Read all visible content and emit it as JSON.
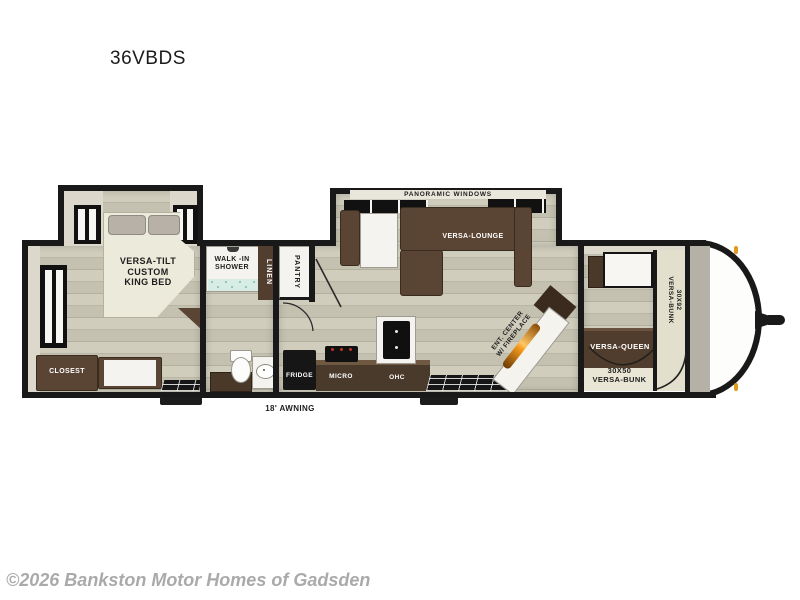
{
  "page": {
    "model": "36VBDS",
    "copyright": "©2026 Bankston Motor Homes of Gadsden"
  },
  "floorplan": {
    "awning_label": "18' AWNING",
    "rear_bedroom": {
      "bed_label": "VERSA-TILT\nCUSTOM\nKING BED",
      "closet_label": "CLOSEST"
    },
    "bathroom": {
      "shower_label": "WALK -IN\nSHOWER",
      "linen_label": "LINEN"
    },
    "kitchen": {
      "pantry_label": "PANTRY",
      "fridge_label": "FRIDGE",
      "micro_label": "MICRO",
      "ohc_label": "OHC"
    },
    "living_area": {
      "windows_label": "PANORAMIC WINDOWS",
      "lounge_label": "VERSA-LOUNGE",
      "ent_center_label": "ENT. CENTER\nW/ FIREPLACE"
    },
    "front_bedroom": {
      "queen_label": "VERSA-QUEEN",
      "bunk_small_label": "30X50\nVERSA-BUNK",
      "bunk_large_label": "30X92\nVERSA-BUNK"
    }
  },
  "colors": {
    "floor_wood": "#c9c6b5",
    "furniture_brown": "#5a4434",
    "wall_black": "#191919",
    "fireplace_glow": "#f59a1a",
    "marker_light_amber": "#e09a20",
    "copyright_gray": "#aaaaaa"
  }
}
